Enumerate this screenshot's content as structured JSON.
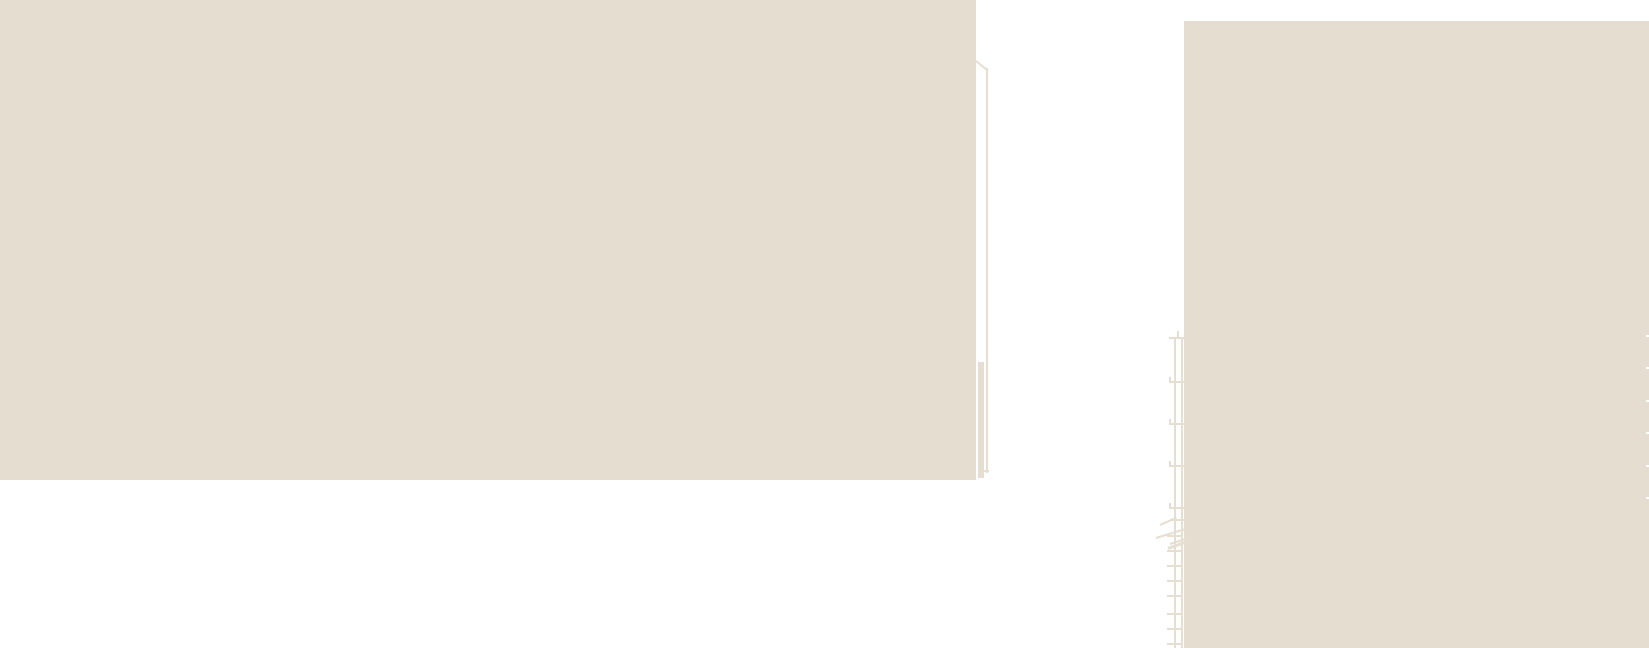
{
  "image": {
    "width": 1649,
    "height": 648,
    "scene_label": "overexposed building facades against white sky with fire-escape ladder and drainpipe"
  },
  "colors": {
    "sky": "#ffffff",
    "facade": "#e5ddd0",
    "detail": "#e6ded1",
    "edge_tick": "#ffffff"
  },
  "scene": {
    "shapes": [
      {
        "name": "left-building-facade",
        "type": "rect",
        "x": 0,
        "y": 0,
        "w": 976,
        "h": 480,
        "color": "facade"
      },
      {
        "name": "right-building-facade",
        "type": "rect",
        "x": 1184,
        "y": 21,
        "w": 465,
        "h": 627,
        "color": "facade"
      },
      {
        "name": "roof-step-diagonal",
        "type": "line",
        "x": 976,
        "y": 60,
        "len": 14.5,
        "thick": 2,
        "angle": 39,
        "color": "detail"
      },
      {
        "name": "drainpipe",
        "type": "rect",
        "x": 986,
        "y": 68,
        "w": 2,
        "h": 405,
        "color": "detail"
      },
      {
        "name": "drainpipe-lower-section",
        "type": "rect",
        "x": 978,
        "y": 362,
        "w": 6,
        "h": 116,
        "color": "detail"
      },
      {
        "name": "drainpipe-foot",
        "type": "rect",
        "x": 978,
        "y": 470,
        "w": 11,
        "h": 2,
        "color": "detail"
      },
      {
        "name": "ladder-rail-left",
        "type": "rect",
        "x": 1174,
        "y": 337,
        "w": 2,
        "h": 311,
        "color": "detail"
      },
      {
        "name": "ladder-rail-right",
        "type": "rect",
        "x": 1181,
        "y": 337,
        "w": 2,
        "h": 311,
        "color": "detail"
      },
      {
        "name": "ladder-top-tick",
        "type": "rect",
        "x": 1177,
        "y": 331,
        "w": 2,
        "h": 6,
        "color": "detail"
      },
      {
        "name": "ladder-rung-upper-1",
        "type": "rect",
        "x": 1169,
        "y": 337,
        "w": 15,
        "h": 2,
        "color": "detail"
      },
      {
        "name": "ladder-rung-upper-2",
        "type": "rect",
        "x": 1169,
        "y": 381,
        "w": 15,
        "h": 2,
        "color": "detail"
      },
      {
        "name": "ladder-rung-upper-3",
        "type": "rect",
        "x": 1169,
        "y": 423,
        "w": 15,
        "h": 2,
        "color": "detail"
      },
      {
        "name": "ladder-rung-upper-4",
        "type": "rect",
        "x": 1169,
        "y": 465,
        "w": 15,
        "h": 2,
        "color": "detail"
      },
      {
        "name": "ladder-rung-upper-5",
        "type": "rect",
        "x": 1169,
        "y": 507,
        "w": 15,
        "h": 2,
        "color": "detail"
      },
      {
        "name": "ladder-rung-end-tick-2",
        "type": "rect",
        "x": 1169,
        "y": 377,
        "w": 2,
        "h": 4,
        "color": "detail"
      },
      {
        "name": "ladder-rung-end-tick-3",
        "type": "rect",
        "x": 1169,
        "y": 419,
        "w": 2,
        "h": 4,
        "color": "detail"
      },
      {
        "name": "ladder-rung-end-tick-4",
        "type": "rect",
        "x": 1169,
        "y": 461,
        "w": 2,
        "h": 4,
        "color": "detail"
      },
      {
        "name": "ladder-rung-end-tick-5",
        "type": "rect",
        "x": 1169,
        "y": 503,
        "w": 2,
        "h": 4,
        "color": "detail"
      },
      {
        "name": "ladder-mid-bar",
        "type": "rect",
        "x": 1170,
        "y": 519,
        "w": 14,
        "h": 2,
        "color": "detail"
      },
      {
        "name": "cable-diagonal-1",
        "type": "line",
        "x": 1160,
        "y": 524,
        "len": 17.5,
        "thick": 2,
        "angle": -24,
        "color": "detail"
      },
      {
        "name": "cable-diagonal-2",
        "type": "line",
        "x": 1156,
        "y": 537,
        "len": 31.5,
        "thick": 2,
        "angle": -17,
        "color": "detail"
      },
      {
        "name": "cable-scribble-1",
        "type": "line",
        "x": 1168,
        "y": 547,
        "len": 23.5,
        "thick": 3,
        "angle": -20,
        "color": "detail"
      },
      {
        "name": "cable-scribble-2",
        "type": "line",
        "x": 1170,
        "y": 543,
        "len": 19,
        "thick": 2,
        "angle": -18,
        "color": "detail"
      },
      {
        "name": "ladder-rung-lower-1",
        "type": "rect",
        "x": 1167,
        "y": 535,
        "w": 16,
        "h": 2,
        "color": "detail"
      },
      {
        "name": "ladder-rung-lower-2",
        "type": "rect",
        "x": 1167,
        "y": 550,
        "w": 16,
        "h": 2,
        "color": "detail"
      },
      {
        "name": "ladder-rung-lower-3",
        "type": "rect",
        "x": 1167,
        "y": 565,
        "w": 16,
        "h": 2,
        "color": "detail"
      },
      {
        "name": "ladder-rung-lower-4",
        "type": "rect",
        "x": 1167,
        "y": 580,
        "w": 16,
        "h": 2,
        "color": "detail"
      },
      {
        "name": "ladder-rung-lower-5",
        "type": "rect",
        "x": 1167,
        "y": 595,
        "w": 16,
        "h": 2,
        "color": "detail"
      },
      {
        "name": "ladder-rung-lower-6",
        "type": "rect",
        "x": 1167,
        "y": 613,
        "w": 16,
        "h": 2,
        "color": "detail"
      },
      {
        "name": "ladder-rung-lower-7",
        "type": "rect",
        "x": 1167,
        "y": 628,
        "w": 16,
        "h": 2,
        "color": "detail"
      },
      {
        "name": "ladder-rung-lower-8",
        "type": "rect",
        "x": 1167,
        "y": 643,
        "w": 16,
        "h": 2,
        "color": "detail"
      },
      {
        "name": "facade-edge-tick-1",
        "type": "rect",
        "x": 1646,
        "y": 335,
        "w": 3,
        "h": 2,
        "color": "edge_tick"
      },
      {
        "name": "facade-edge-tick-2",
        "type": "rect",
        "x": 1646,
        "y": 367,
        "w": 3,
        "h": 2,
        "color": "edge_tick"
      },
      {
        "name": "facade-edge-tick-3",
        "type": "rect",
        "x": 1646,
        "y": 400,
        "w": 3,
        "h": 2,
        "color": "edge_tick"
      },
      {
        "name": "facade-edge-tick-4",
        "type": "rect",
        "x": 1646,
        "y": 432,
        "w": 3,
        "h": 2,
        "color": "edge_tick"
      },
      {
        "name": "facade-edge-tick-5",
        "type": "rect",
        "x": 1646,
        "y": 465,
        "w": 3,
        "h": 2,
        "color": "edge_tick"
      },
      {
        "name": "facade-edge-tick-6",
        "type": "rect",
        "x": 1646,
        "y": 497,
        "w": 3,
        "h": 2,
        "color": "edge_tick"
      }
    ]
  }
}
